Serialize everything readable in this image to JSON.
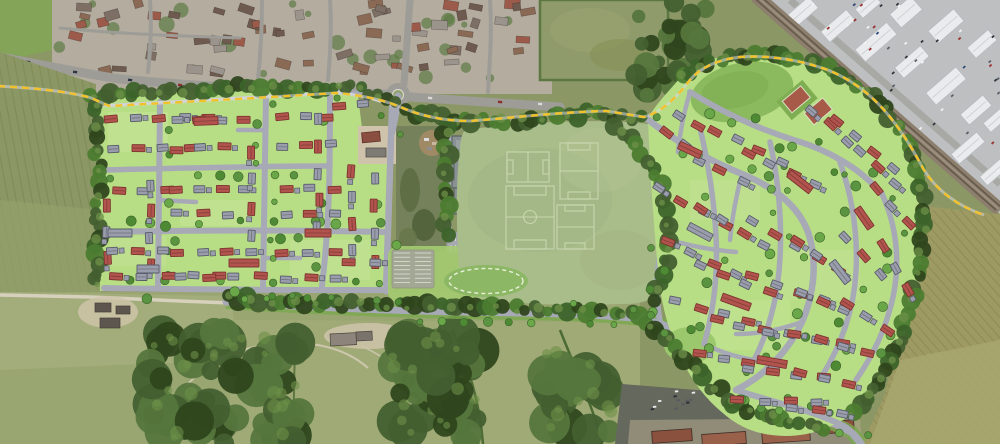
{
  "meta": {
    "description": "Aerial masterplan visualisation of a residential development: two housing parcels with red and grey roofed homes either side of central playing fields and a school, bounded by a dashed yellow site boundary, an existing village to the north, an industrial estate and railway to the north-east, and farmland and woodland to the south and west.",
    "image_type": "aerial-photo-with-masterplan-overlay"
  },
  "palette": {
    "fieldOlive": "#8b9765",
    "fieldLight": "#a3ad7b",
    "fieldTan": "#9d9a63",
    "fieldTanLight": "#aaa771",
    "tramline": "#877f50",
    "striation": "#78854e",
    "woodland": "#435f30",
    "woodDark": "#2f461d",
    "woodMid": "#55763d",
    "canopyLight": "#6d9048",
    "villageBase": "#b3ac9f",
    "roofBrown": "#8a6a55",
    "roofDark": "#6e5a4e",
    "roofGreyV": "#9a948c",
    "roofRedV": "#9b5a4a",
    "aerialRoad": "#9d9c96",
    "lanePale": "#d6d0bc",
    "yardPale": "#cfc4ab",
    "industrialBase": "#bdbfc1",
    "indRoof": "#e9ebed",
    "indRoofEdge": "#b9bdc0",
    "indPark": "#9aa0a6",
    "railBed": "#8c7f6e",
    "railLine": "#65594a",
    "carparkDark": "#65685c",
    "shedRed": "#8a513f",
    "shedRedLight": "#99604a",
    "shedGrey": "#6b5c52",
    "planGreen": "#b7dd85",
    "planGreenLight": "#c9e79b",
    "lawnBright": "#a4cb70",
    "moundGreen": "#8cb765",
    "bufferGreen": "#4c7c30",
    "treeGreen": "#5a9440",
    "treeDark": "#3c632a",
    "treeMid": "#4e8a34",
    "roadGrey": "#a7a9b6",
    "pathGrey": "#cfd0d6",
    "houseRed": "#b2544d",
    "houseRedEdge": "#7c352f",
    "houseGrey": "#9a9dac",
    "houseGreyEdge": "#585b68",
    "schoolGrey": "#8a9192",
    "schoolEdge": "#5a6162",
    "schoolRoof": "#9aa1a1",
    "pitchGreen": "#a9bd8b",
    "pitchMottle": "#a0b483",
    "pitchLine": "#cfdcb4",
    "dashYellow": "#f3c22b",
    "courtRed": "#a85a48",
    "courtPad": "#7fae52",
    "verdeGreen": "#79a94e",
    "scrub": "#75815a",
    "dirt": "#a08a66"
  },
  "regions": [
    {
      "name": "existing-village",
      "label": "Existing village housing (aerial)"
    },
    {
      "name": "industrial-estate",
      "label": "Industrial estate (aerial)"
    },
    {
      "name": "railway-line",
      "label": "Railway line"
    },
    {
      "name": "western-housing-parcel",
      "label": "Western housing parcel (proposed)"
    },
    {
      "name": "eastern-housing-parcel",
      "label": "Eastern housing parcel (proposed)"
    },
    {
      "name": "playing-fields",
      "label": "Playing fields with marked pitches"
    },
    {
      "name": "school-building",
      "label": "School building and car park"
    },
    {
      "name": "site-boundary",
      "label": "Dashed yellow site boundary"
    },
    {
      "name": "spine-road",
      "label": "Southern spine road with tree-lined verges"
    },
    {
      "name": "roundabout",
      "label": "Existing roundabout junction"
    },
    {
      "name": "tennis-courts",
      "label": "Tennis courts"
    },
    {
      "name": "attenuation-mound",
      "label": "Oval green mound with dashed outline"
    },
    {
      "name": "woodland",
      "label": "Woodland (aerial)"
    },
    {
      "name": "farmland",
      "label": "Arable farmland (aerial)"
    }
  ],
  "plan": {
    "west_rows": [
      [
        112,
        120,
        -2,
        5,
        24,
        "rgrgr"
      ],
      [
        112,
        150,
        -2,
        4,
        26,
        "grgr"
      ],
      [
        118,
        190,
        0,
        3,
        25,
        "rgr"
      ],
      [
        107,
        207,
        90,
        3,
        25,
        "rgr"
      ],
      [
        112,
        252,
        0,
        3,
        26,
        "grg"
      ],
      [
        116,
        276,
        0,
        5,
        26,
        "rgrgr"
      ],
      [
        178,
        121,
        -2,
        4,
        22,
        "grgr"
      ],
      [
        177,
        149,
        -2,
        3,
        24,
        "rgr"
      ],
      [
        176,
        190,
        0,
        4,
        23,
        "rgrg"
      ],
      [
        176,
        214,
        0,
        3,
        26,
        "grg"
      ],
      [
        178,
        252,
        0,
        4,
        24,
        "rgrg"
      ],
      [
        182,
        277,
        0,
        4,
        26,
        "grgr"
      ],
      [
        283,
        118,
        -2,
        3,
        22,
        "rgr"
      ],
      [
        283,
        146,
        -2,
        3,
        24,
        "grg"
      ],
      [
        286,
        189,
        0,
        3,
        24,
        "rgr"
      ],
      [
        286,
        215,
        0,
        3,
        24,
        "grg"
      ],
      [
        283,
        253,
        0,
        3,
        26,
        "rgr"
      ],
      [
        287,
        279,
        0,
        3,
        24,
        "grg"
      ],
      [
        150,
        186,
        90,
        4,
        26,
        "grgr"
      ],
      [
        252,
        152,
        90,
        4,
        28,
        "rgrg"
      ],
      [
        318,
        120,
        90,
        5,
        27,
        "grgrg"
      ],
      [
        352,
        172,
        90,
        4,
        26,
        "rgrg"
      ],
      [
        374,
        178,
        90,
        4,
        28,
        "grgr"
      ],
      [
        350,
        262,
        0,
        2,
        24,
        "rg"
      ],
      [
        340,
        105,
        -2,
        2,
        22,
        "rg"
      ]
    ],
    "east_rows": [
      [
        714,
        130,
        25,
        4,
        25,
        "rgrg"
      ],
      [
        698,
        160,
        25,
        3,
        25,
        "grg"
      ],
      [
        748,
        152,
        25,
        4,
        25,
        "rgrg"
      ],
      [
        812,
        110,
        40,
        3,
        24,
        "grg"
      ],
      [
        838,
        122,
        40,
        4,
        24,
        "rgrg"
      ],
      [
        860,
        152,
        42,
        3,
        24,
        "grg"
      ],
      [
        876,
        188,
        48,
        3,
        24,
        "rgr"
      ],
      [
        660,
        188,
        30,
        4,
        25,
        "grgr"
      ],
      [
        700,
        208,
        30,
        4,
        25,
        "rgrg"
      ],
      [
        752,
        222,
        28,
        4,
        25,
        "grgr"
      ],
      [
        798,
        242,
        35,
        3,
        24,
        "rgr"
      ],
      [
        846,
        238,
        48,
        3,
        25,
        "grg"
      ],
      [
        884,
        246,
        62,
        3,
        25,
        "rgr"
      ],
      [
        668,
        242,
        25,
        4,
        25,
        "rgrg"
      ],
      [
        700,
        264,
        22,
        4,
        25,
        "grgr"
      ],
      [
        752,
        277,
        18,
        4,
        25,
        "rgrg"
      ],
      [
        800,
        292,
        22,
        3,
        24,
        "grg"
      ],
      [
        846,
        304,
        32,
        3,
        25,
        "rgr"
      ],
      [
        676,
        302,
        15,
        4,
        25,
        "grgr"
      ],
      [
        716,
        320,
        12,
        4,
        25,
        "rgrg"
      ],
      [
        768,
        332,
        8,
        4,
        25,
        "grgr"
      ],
      [
        820,
        340,
        16,
        3,
        24,
        "rgr"
      ],
      [
        700,
        354,
        10,
        4,
        25,
        "rgrg"
      ],
      [
        748,
        370,
        6,
        4,
        25,
        "grgr"
      ],
      [
        800,
        374,
        12,
        3,
        25,
        "rgr"
      ],
      [
        738,
        400,
        2,
        4,
        26,
        "rgrg"
      ],
      [
        792,
        407,
        8,
        3,
        26,
        "grg"
      ],
      [
        666,
        132,
        35,
        2,
        24,
        "rg"
      ],
      [
        680,
        115,
        30,
        2,
        22,
        "gr"
      ]
    ],
    "blocks": [
      [
        206,
        121,
        -2,
        24,
        8,
        "r"
      ],
      [
        244,
        263,
        0,
        30,
        8,
        "r"
      ],
      [
        148,
        269,
        0,
        22,
        8,
        "g"
      ],
      [
        318,
        233,
        0,
        26,
        8,
        "r"
      ],
      [
        120,
        233,
        0,
        24,
        8,
        "g"
      ],
      [
        690,
        150,
        25,
        24,
        8,
        "r"
      ],
      [
        736,
        302,
        20,
        30,
        8,
        "r"
      ],
      [
        700,
        232,
        28,
        26,
        8,
        "g"
      ],
      [
        772,
        362,
        10,
        30,
        8,
        "r"
      ],
      [
        840,
        272,
        52,
        26,
        8,
        "g"
      ],
      [
        800,
        182,
        38,
        28,
        8,
        "r"
      ],
      [
        864,
        218,
        55,
        24,
        8,
        "r"
      ]
    ]
  },
  "aerial": {
    "village_clutter_count": 66,
    "industrial_buildings": [
      [
        800,
        14,
        36,
        15
      ],
      [
        838,
        26,
        34,
        14
      ],
      [
        876,
        42,
        42,
        16
      ],
      [
        912,
        62,
        34,
        14
      ],
      [
        946,
        86,
        40,
        16
      ],
      [
        976,
        110,
        30,
        14
      ],
      [
        906,
        12,
        28,
        18
      ],
      [
        946,
        26,
        34,
        16
      ],
      [
        982,
        44,
        28,
        14
      ],
      [
        968,
        148,
        34,
        13
      ],
      [
        994,
        172,
        28,
        12
      ],
      [
        868,
        6,
        24,
        12
      ],
      [
        996,
        120,
        24,
        12
      ]
    ],
    "road_cars": [
      [
        28,
        62
      ],
      [
        75,
        72
      ],
      [
        130,
        80
      ],
      [
        180,
        85
      ],
      [
        235,
        88
      ],
      [
        300,
        90
      ],
      [
        350,
        92
      ],
      [
        430,
        98
      ],
      [
        500,
        102
      ],
      [
        540,
        104
      ]
    ],
    "farm_buildings_west": [
      [
        95,
        303,
        16,
        9
      ],
      [
        116,
        306,
        14,
        8
      ],
      [
        100,
        318,
        20,
        10
      ]
    ],
    "farm_buildings_center": [
      [
        330,
        334,
        26,
        12
      ],
      [
        356,
        332,
        16,
        9
      ]
    ],
    "sheds_bottom_right": [
      [
        652,
        430,
        40,
        12
      ],
      [
        702,
        433,
        44,
        12
      ],
      [
        762,
        429,
        48,
        13
      ],
      [
        818,
        421,
        36,
        12
      ]
    ]
  }
}
